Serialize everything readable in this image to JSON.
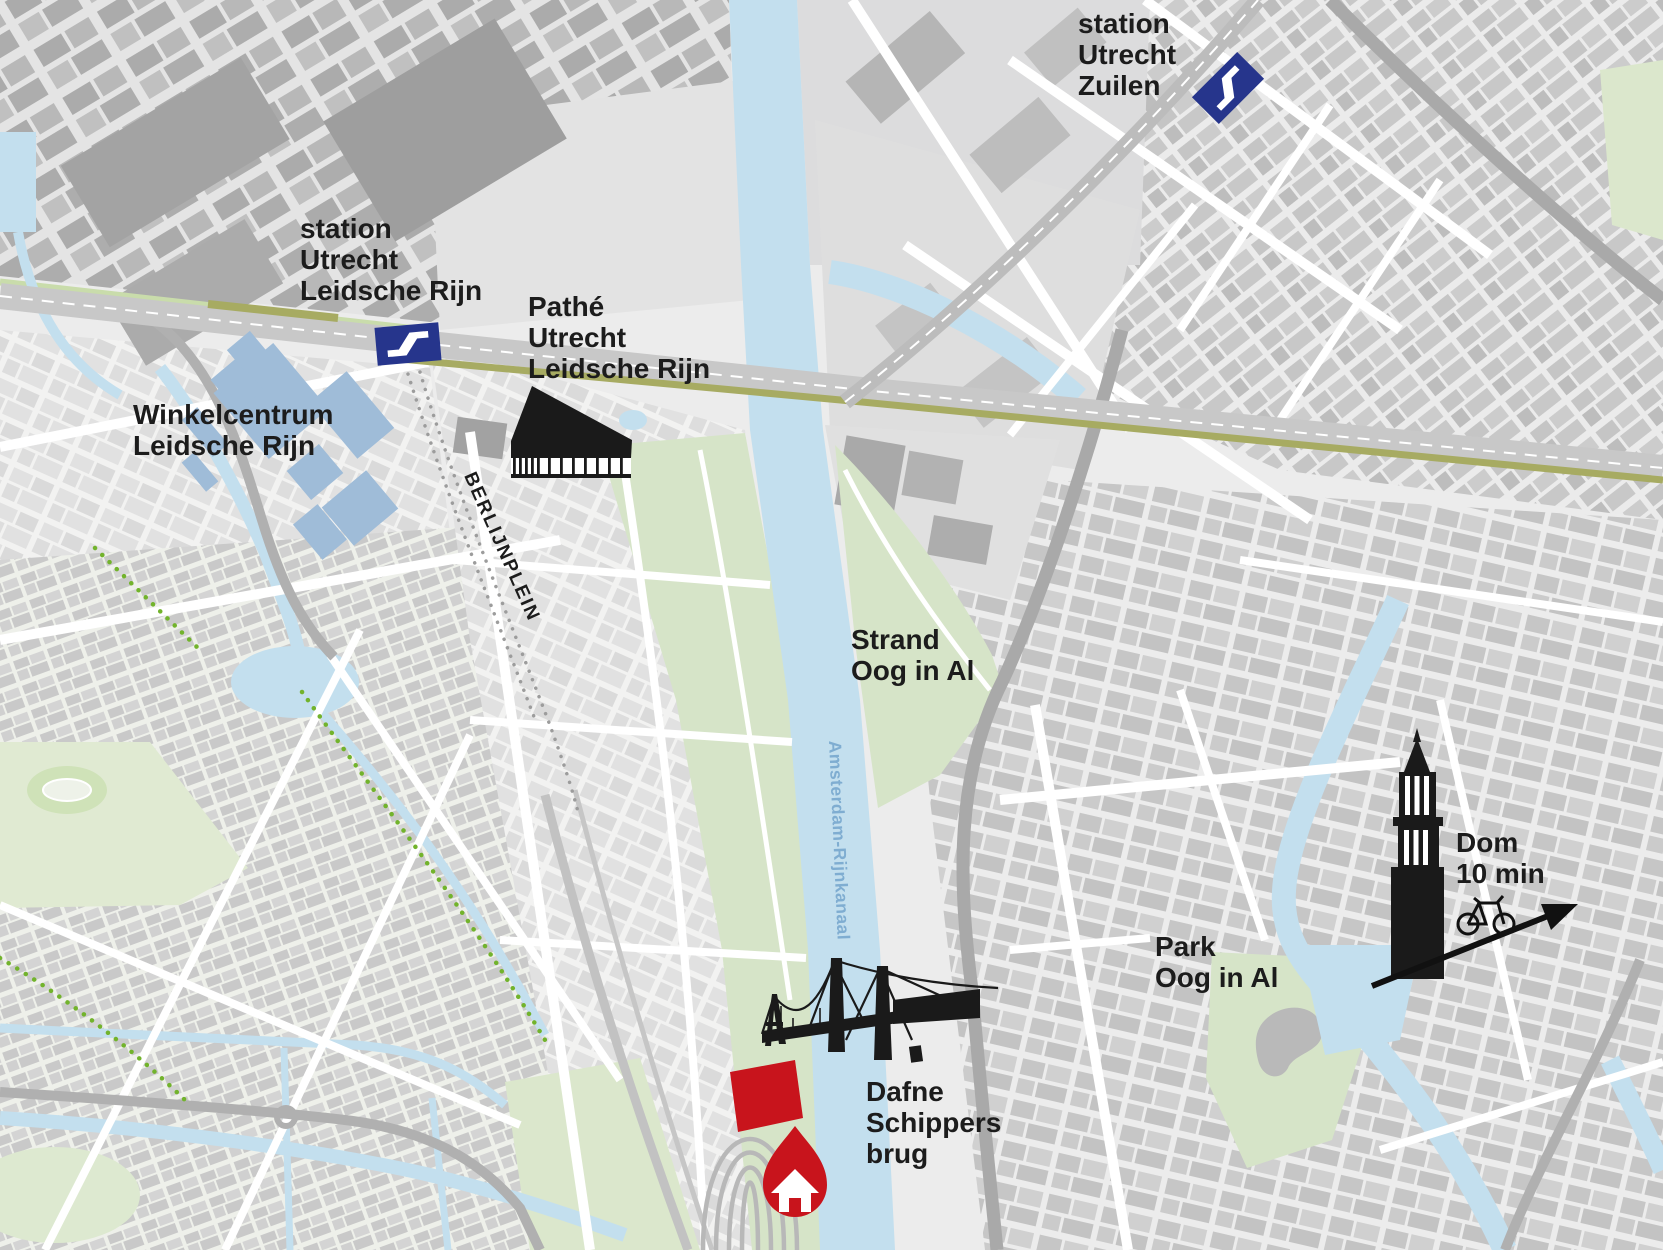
{
  "canvas": {
    "width": 1663,
    "height": 1250
  },
  "colors": {
    "background": "#ececec",
    "water": "#c3dfee",
    "park_green": "#d6e4c8",
    "rail_olive": "#a7ab62",
    "ns_blue": "#26358c",
    "marker_red": "#c8141c",
    "label_black": "#1c1c1c",
    "water_label_blue": "#7fadd1",
    "building_blue": "#9fbcd8"
  },
  "labels": {
    "station_zuilen": {
      "line1": "station",
      "line2": "Utrecht",
      "line3": "Zuilen"
    },
    "station_leidsche_rijn": {
      "line1": "station",
      "line2": "Utrecht",
      "line3": "Leidsche Rijn"
    },
    "pathe_cinema": {
      "line1": "Pathé",
      "line2": "Utrecht",
      "line3": "Leidsche Rijn"
    },
    "winkelcentrum": {
      "line1": "Winkelcentrum",
      "line2": "Leidsche Rijn"
    },
    "berlijnplein": {
      "text": "BERLIJNPLEIN"
    },
    "strand": {
      "line1": "Strand",
      "line2": "Oog in Al"
    },
    "canal": {
      "text": "Amsterdam-Rijnkanaal"
    },
    "park": {
      "line1": "Park",
      "line2": "Oog in Al"
    },
    "dom": {
      "line1": "Dom",
      "line2": "10 min"
    },
    "dafne_schippersbrug": {
      "line1": "Dafne",
      "line2": "Schippers",
      "line3": "brug"
    }
  }
}
